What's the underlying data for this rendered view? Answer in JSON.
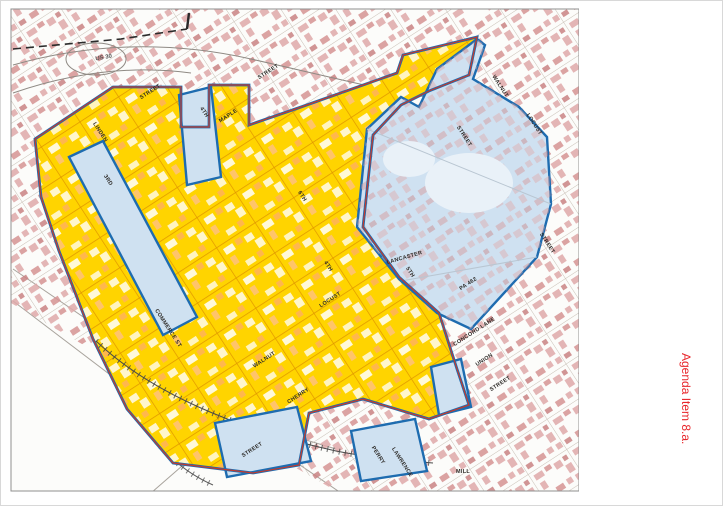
{
  "window": {
    "agenda_label": "Agenda Item 8.a."
  },
  "title": {
    "line1": "Columbia Borough",
    "line2": "Historic District"
  },
  "legend": {
    "heading": "LEGEND",
    "items": [
      "Columbia Historic District",
      "Rivers, Streams, & Lakes",
      "Buildings",
      "Columbia Historic Boundary",
      "Municipal Boundaries",
      "Parcel Boundaries",
      "Roads",
      "Railroads"
    ]
  },
  "callout": {
    "line1": "Proposed",
    "line2": "Historic",
    "line3": "District",
    "line4": "Expansion"
  },
  "scale_text": "1 in. = 600 ft.",
  "credit": {
    "county": "LANCASTER COUNTY",
    "word1": "GEOGRAPHIC",
    "word2": "INFORMATION",
    "word3": "SYSTEM",
    "tagline": "Planning Commission"
  },
  "map": {
    "streets": {
      "us30": "US 30",
      "street": "STREET",
      "linden": "LINDEN",
      "third": "3RD",
      "fourth": "4TH",
      "fifth": "5TH",
      "sixth": "6TH",
      "maple": "MAPLE",
      "walnut": "WALNUT",
      "locust": "LOCUST",
      "cherry": "CHERRY",
      "union": "UNION",
      "lancaster": "LANCASTER",
      "commerce": "COMMERCE ST",
      "pa462": "PA 462",
      "concord": "CONCORD LANE",
      "perry": "PERRY",
      "lawrence": "LAWRENCE",
      "mill": "MILL"
    }
  },
  "colors": {
    "district_yellow": "#ffd400",
    "expansion_blue": "#cfe1f1",
    "boundary_blue": "#1e6cb0",
    "historic_red": "#c23b2e",
    "agenda_red": "#e8262b"
  }
}
